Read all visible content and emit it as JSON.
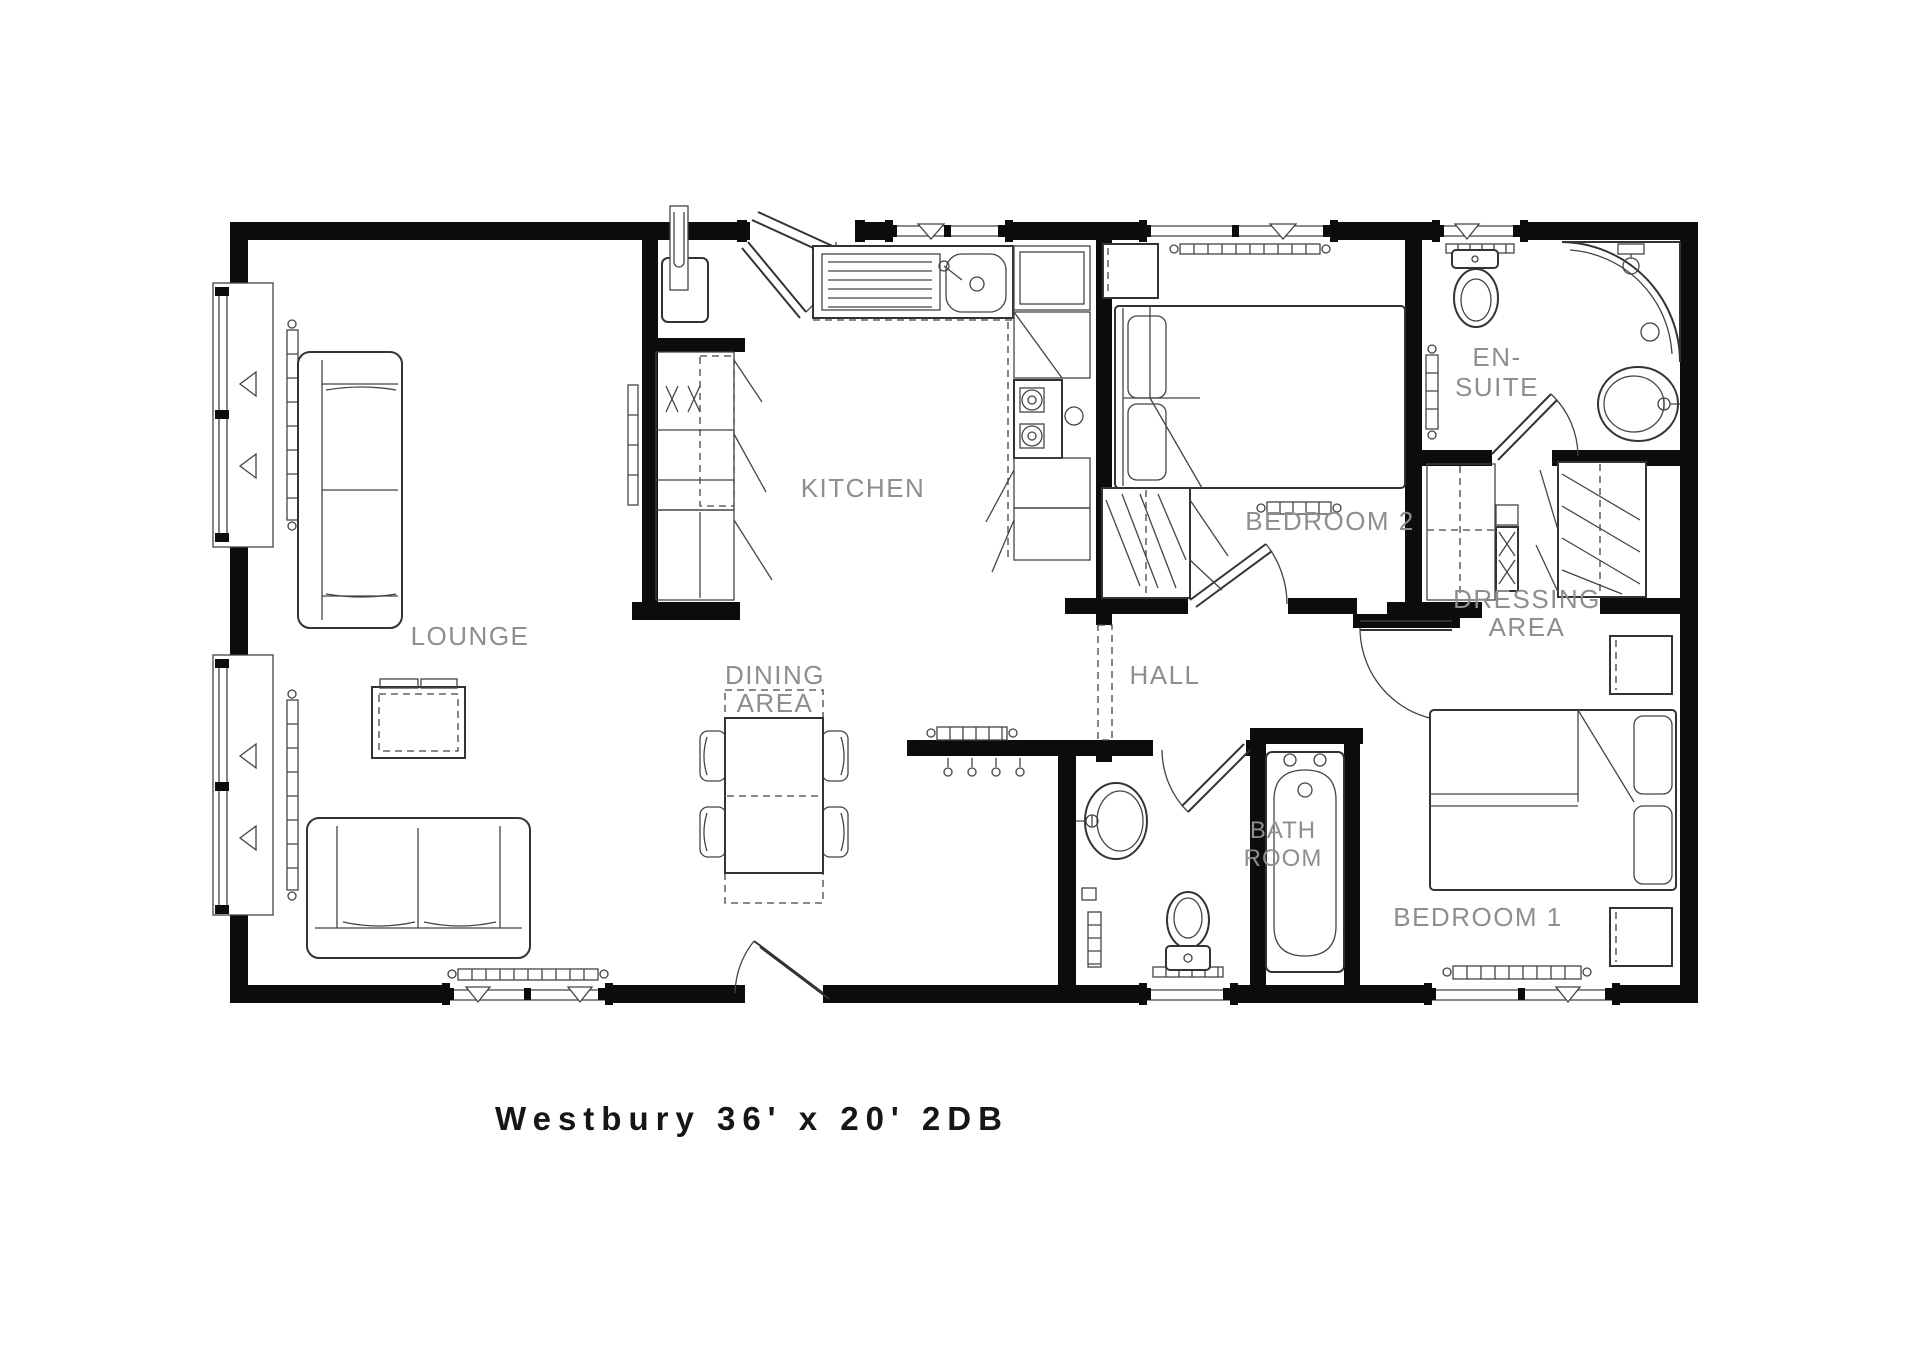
{
  "title": "Westbury 36' x 20' 2DB",
  "rooms": {
    "lounge": "LOUNGE",
    "kitchen": "KITCHEN",
    "dining_line1": "DINING",
    "dining_line2": "AREA",
    "hall": "HALL",
    "bedroom2": "BEDROOM 2",
    "ensuite_line1": "EN-",
    "ensuite_line2": "SUITE",
    "dressing_line1": "DRESSING",
    "dressing_line2": "AREA",
    "bathroom_line1": "BATH",
    "bathroom_line2": "ROOM",
    "bedroom1": "BEDROOM 1"
  },
  "colors": {
    "wall": "#0c0c0c",
    "furniture_line": "#333333",
    "label": "#8e8e8e",
    "background": "#ffffff"
  }
}
